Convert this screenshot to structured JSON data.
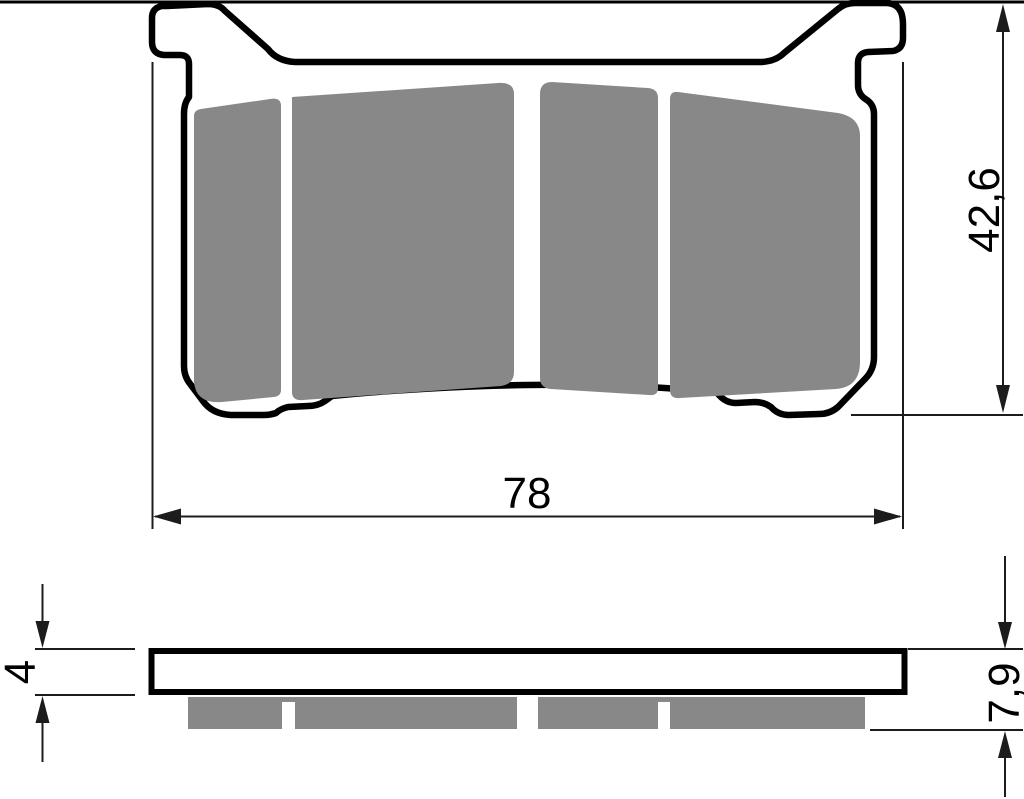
{
  "page": {
    "background": "#ffffff",
    "top_border_color": "#000000"
  },
  "part": {
    "outline_color": "#000000",
    "friction_color": "#888888"
  },
  "dims": {
    "width": {
      "label": "78"
    },
    "height": {
      "label": "42,6"
    },
    "backplate_thickness": {
      "label": "4"
    },
    "total_thickness": {
      "label": "7,9"
    }
  }
}
